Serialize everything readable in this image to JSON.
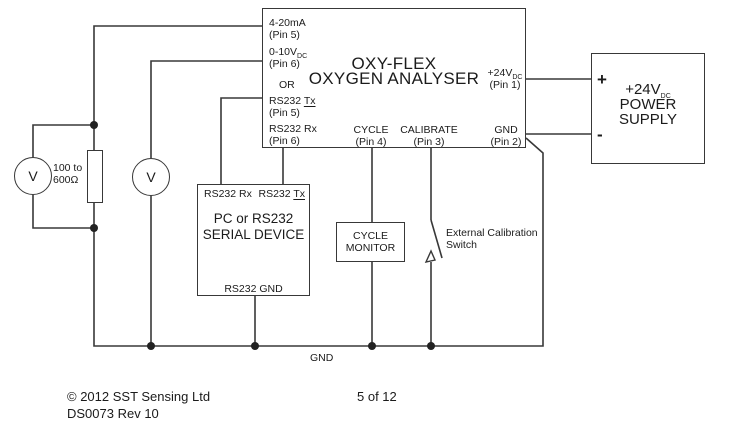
{
  "analyser": {
    "title1": "OXY-FLEX",
    "title2": "OXYGEN ANALYSER",
    "pin_420_l1": "4-20mA",
    "pin_420_l2": "(Pin 5)",
    "pin_010_pre": "0-10V",
    "pin_010_sub": "DC",
    "pin_010_l2": "(Pin 6)",
    "or_label": "OR",
    "pin_tx_pre": "RS232 ",
    "pin_tx_und": "Tx",
    "pin_tx_l2": "(Pin 5)",
    "pin_rx_l1": "RS232 Rx",
    "pin_rx_l2": "(Pin 6)",
    "pin_24_pre": "+24V",
    "pin_24_sub": "DC",
    "pin_24_l2": "(Pin 1)",
    "pin_cycle_l1": "CYCLE",
    "pin_cycle_l2": "(Pin 4)",
    "pin_cal_l1": "CALIBRATE",
    "pin_cal_l2": "(Pin 3)",
    "pin_gnd_l1": "GND",
    "pin_gnd_l2": "(Pin 2)"
  },
  "psu": {
    "plus": "+",
    "minus": "-",
    "line1_pre": "+24V",
    "line1_sub": "DC",
    "line2": "POWER",
    "line3": "SUPPLY"
  },
  "serial_device": {
    "rx": "RS232 Rx",
    "tx_pre": "RS232 ",
    "tx_und": "Tx",
    "name1": "PC or RS232",
    "name2": "SERIAL DEVICE",
    "gnd": "RS232 GND"
  },
  "cycle_monitor": {
    "line1": "CYCLE",
    "line2": "MONITOR"
  },
  "voltmeter1": "V",
  "voltmeter2": "V",
  "resistor": {
    "line1": "100 to",
    "line2": "600Ω"
  },
  "ext_switch": {
    "line1": "External Calibration",
    "line2": "Switch"
  },
  "gnd_bus_label": "GND",
  "footer": {
    "copyright": "© 2012 SST Sensing Ltd",
    "docref": "DS0073 Rev 10",
    "page": "5 of 12"
  },
  "colors": {
    "line": "#383838",
    "text": "#1b1b1b",
    "background": "#ffffff"
  }
}
